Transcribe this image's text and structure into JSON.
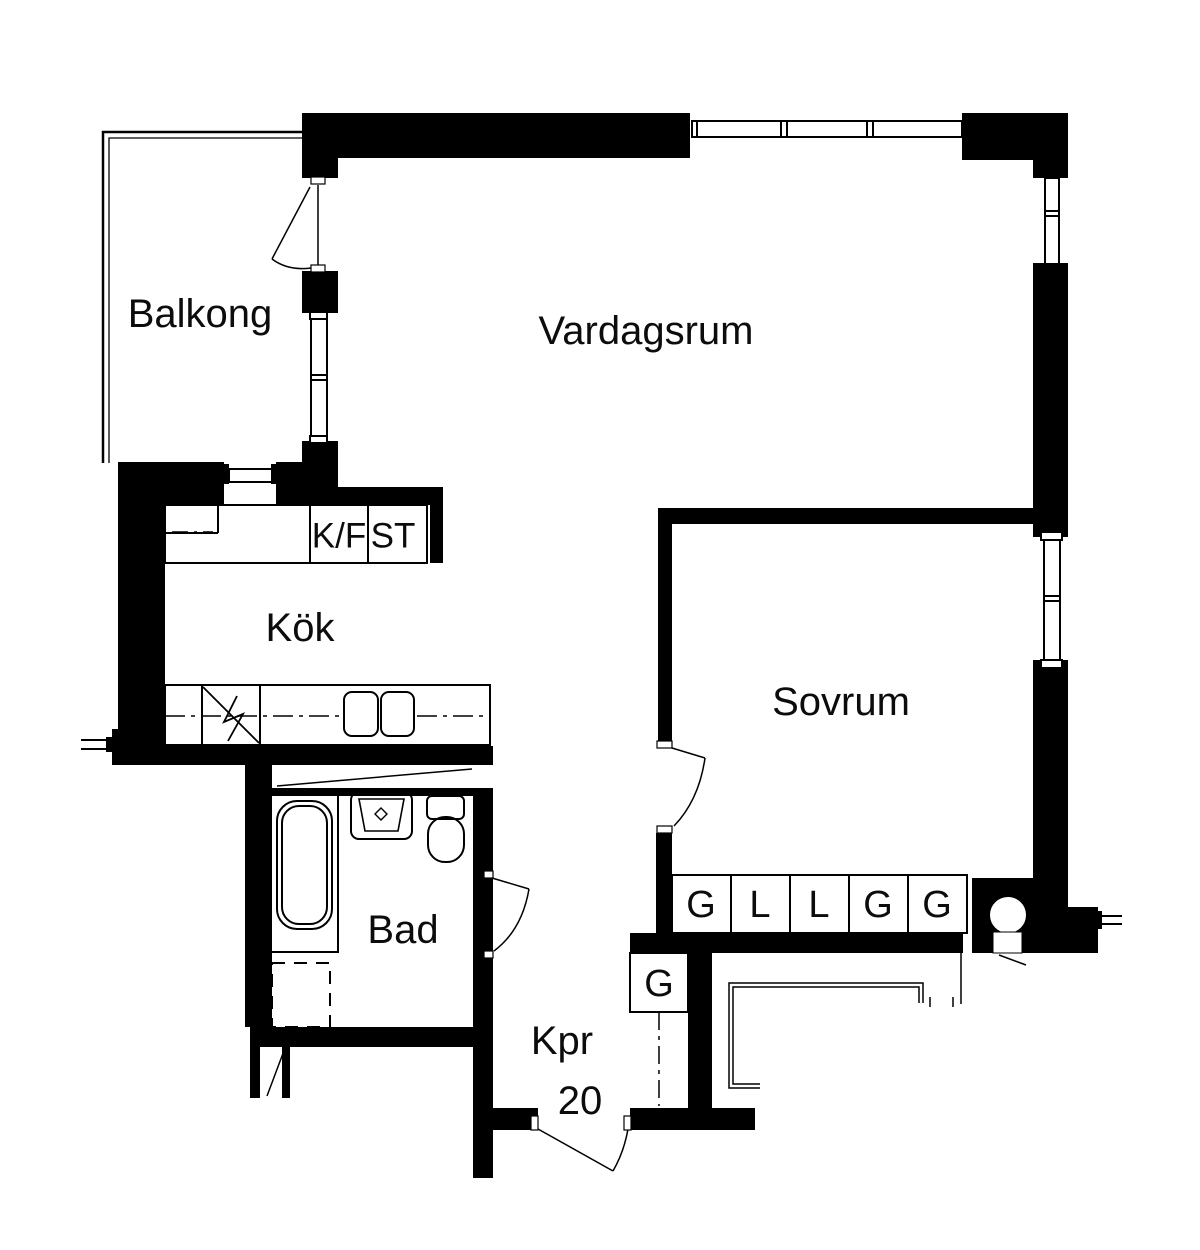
{
  "floorplan": {
    "colors": {
      "wall": "#000000",
      "line": "#000000",
      "background": "#ffffff"
    },
    "rooms": [
      {
        "id": "balkong",
        "label": "Balkong"
      },
      {
        "id": "vardagsrum",
        "label": "Vardagsrum"
      },
      {
        "id": "kok",
        "label": "Kök"
      },
      {
        "id": "sovrum",
        "label": "Sovrum"
      },
      {
        "id": "bad",
        "label": "Bad"
      },
      {
        "id": "kpr",
        "label": "Kpr"
      }
    ],
    "entry_area_number": "20",
    "kitchen_units": {
      "fridge_freezer": "K/F",
      "tall_cabinet": "ST"
    },
    "hall_cabinet": "G",
    "bedroom_wardrobes": [
      "G",
      "L",
      "L",
      "G",
      "G"
    ],
    "icons": {
      "bathtub": "bathtub-icon",
      "sink": "sink-icon",
      "toilet": "toilet-icon",
      "stove": "stove-icon",
      "dishwasher": "dishwasher-icon",
      "column": "round-column-icon"
    }
  }
}
